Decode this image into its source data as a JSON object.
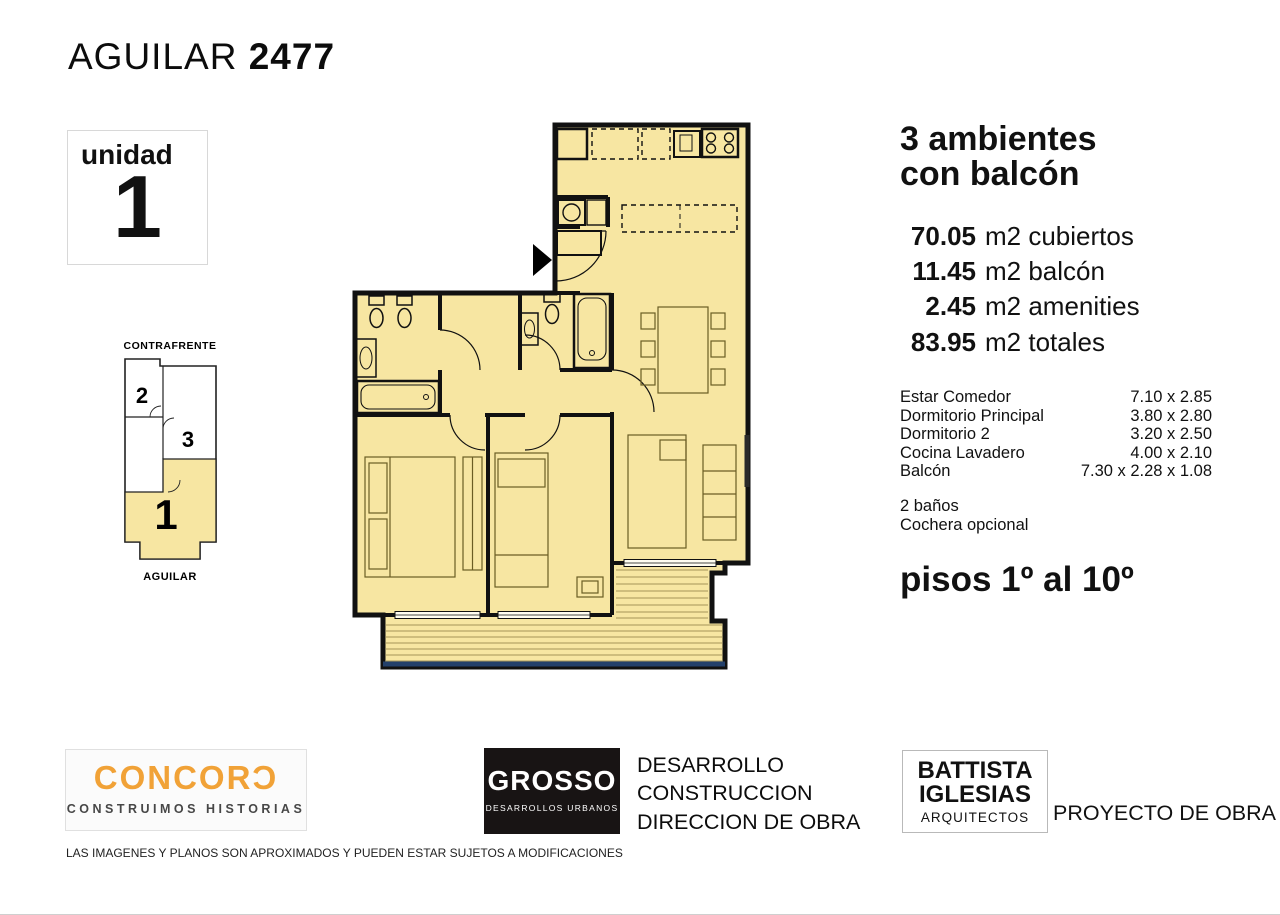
{
  "header": {
    "street": "AGUILAR ",
    "number": "2477"
  },
  "unit_badge": {
    "label": "unidad",
    "number": "1"
  },
  "locator": {
    "top_label": "CONTRAFRENTE",
    "bottom_label": "AGUILAR",
    "units": [
      {
        "label": "2"
      },
      {
        "label": "3"
      },
      {
        "label": "1"
      }
    ]
  },
  "summary": {
    "line1": "3 ambientes",
    "line2": "con balcón",
    "areas": [
      {
        "value": "70.05",
        "label": "m2 cubiertos"
      },
      {
        "value": "11.45",
        "label": "m2 balcón"
      },
      {
        "value": "2.45",
        "label": "m2 amenities"
      },
      {
        "value": "83.95",
        "label": "m2 totales"
      }
    ]
  },
  "details": {
    "rooms": [
      {
        "name": "Estar Comedor",
        "size": "7.10 x 2.85"
      },
      {
        "name": "Dormitorio Principal",
        "size": "3.80 x 2.80"
      },
      {
        "name": "Dormitorio 2",
        "size": "3.20 x 2.50"
      },
      {
        "name": "Cocina Lavadero",
        "size": "4.00 x 2.10"
      },
      {
        "name": "Balcón",
        "size": "7.30 x 2.28 x 1.08"
      }
    ],
    "extras": [
      "2 baños",
      "Cochera opcional"
    ],
    "floors": "pisos 1º al 10º"
  },
  "footer": {
    "concord": {
      "name": "CONCORƆ",
      "tagline": "CONSTRUIMOS HISTORIAS"
    },
    "grosso": {
      "name": "GROSSO",
      "tagline": "DESARROLLOS URBANOS",
      "roles": [
        "DESARROLLO",
        "CONSTRUCCION",
        "DIRECCION DE OBRA"
      ]
    },
    "battista": {
      "line1": "BATTISTA",
      "line2": "IGLESIAS",
      "line3": "ARQUITECTOS",
      "role": "PROYECTO DE OBRA"
    },
    "disclaimer": "LAS IMAGENES Y PLANOS SON APROXIMADOS Y PUEDEN ESTAR SUJETOS A MODIFICACIONES"
  },
  "colors": {
    "plan_fill": "#F7E6A2",
    "furniture": "#6b5d24",
    "wall": "#111111",
    "balcony_edge": "#23406b",
    "brand_orange": "#F1A237"
  }
}
